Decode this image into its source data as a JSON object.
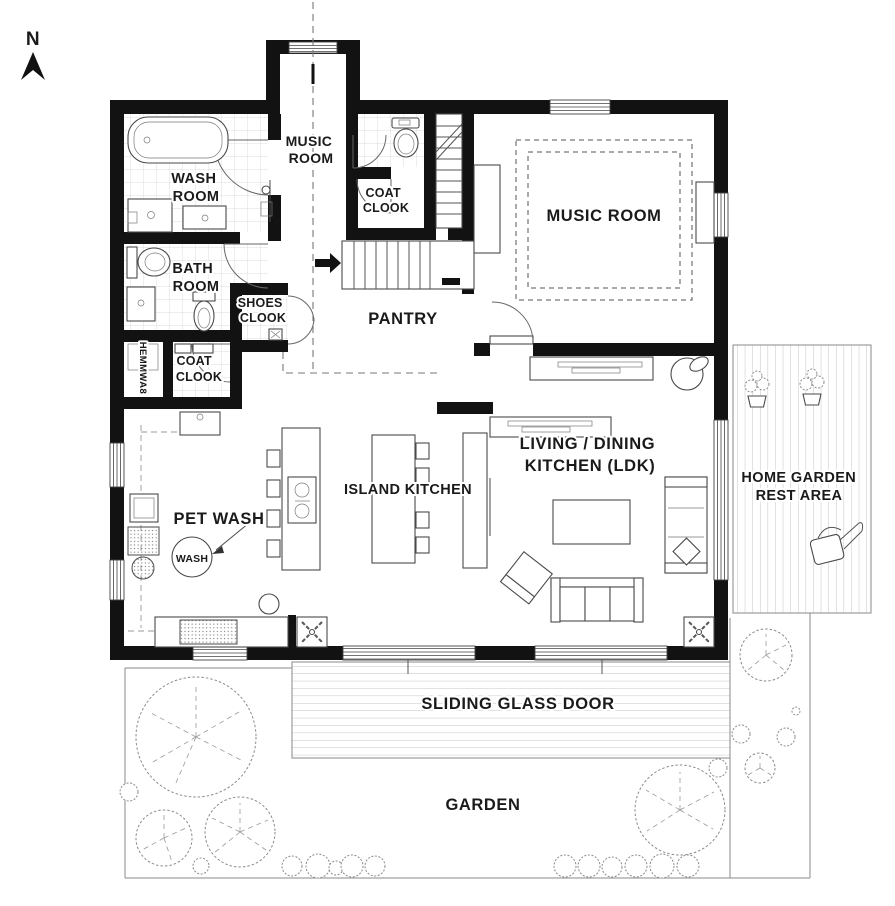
{
  "compass": {
    "label": "N"
  },
  "rooms": {
    "hall_music_room": {
      "line1": "MUSIC",
      "line2": "ROOM"
    },
    "wash_room": {
      "line1": "WASH",
      "line2": "ROOM"
    },
    "bath_room": {
      "line1": "BATH",
      "line2": "ROOM"
    },
    "shoes_clook": {
      "line1": "SHOES",
      "line2": "CLOOK"
    },
    "coat_clook_upper": {
      "line1": "COAT",
      "line2": "CLOOK"
    },
    "coat_clook_lower": {
      "line1": "COAT",
      "line2": "CLOOK"
    },
    "laundry_label": "HEMMWA8",
    "pantry": {
      "label": "PANTRY"
    },
    "music_room": {
      "label": "MUSIC ROOM"
    },
    "ldk": {
      "line1": "LIVING / DINING",
      "line2": "KITCHEN  (LDK)"
    },
    "island_kitchen": {
      "label": "ISLAND KITCHEN"
    },
    "pet_wash": {
      "label": "PET WASH",
      "tub": "WASH"
    }
  },
  "outdoor": {
    "home_garden": {
      "line1": "HOME GARDEN",
      "line2": "REST AREA"
    },
    "sliding_glass_door": {
      "label": "SLIDING GLASS DOOR"
    },
    "garden": {
      "label": "GARDEN"
    }
  },
  "colors": {
    "wall": "#121212",
    "line_dark": "#4a4a4a",
    "line_mid": "#777777",
    "tile": "#d4d4d4",
    "text": "#1a1a1a",
    "background": "#ffffff",
    "garden_line": "#8a8a8a"
  }
}
